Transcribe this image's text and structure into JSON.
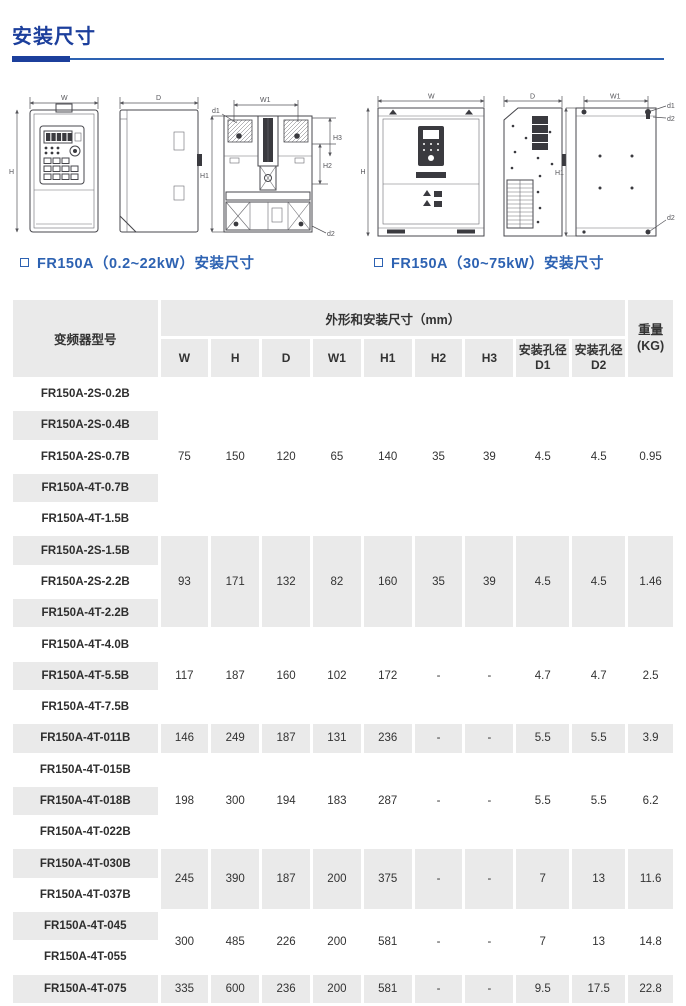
{
  "page": {
    "title": "安装尺寸"
  },
  "colors": {
    "heading_blue": "#1c3f9c",
    "caption_blue": "#2d62b2",
    "row_gray": "#eaeaea",
    "text_dark": "#333333"
  },
  "figures": {
    "small_unit": {
      "caption": "FR150A（0.2~22kW）安装尺寸",
      "labels": {
        "w": "W",
        "h": "H",
        "d": "D",
        "w1": "W1",
        "h1": "H1",
        "h2": "H2",
        "h3": "H3",
        "d1": "d1",
        "d2": "d2"
      }
    },
    "large_unit": {
      "caption": "FR150A（30~75kW）安装尺寸",
      "labels": {
        "w": "W",
        "h": "H",
        "d": "D",
        "w1": "W1",
        "h1": "H1",
        "d1": "d1",
        "d2": "d2"
      }
    }
  },
  "table": {
    "header": {
      "model": "变频器型号",
      "dims_group": "外形和安装尺寸（mm）",
      "weight_line1": "重量",
      "weight_line2": "(KG)",
      "dim_cols": [
        "W",
        "H",
        "D",
        "W1",
        "H1",
        "H2",
        "H3"
      ],
      "hole1_line1": "安装孔径",
      "hole1_line2": "D1",
      "hole2_line1": "安装孔径",
      "hole2_line2": "D2"
    },
    "groups": [
      {
        "models": [
          "FR150A-2S-0.2B",
          "FR150A-2S-0.4B",
          "FR150A-2S-0.7B",
          "FR150A-4T-0.7B",
          "FR150A-4T-1.5B"
        ],
        "values": [
          "75",
          "150",
          "120",
          "65",
          "140",
          "35",
          "39",
          "4.5",
          "4.5",
          "0.95"
        ]
      },
      {
        "models": [
          "FR150A-2S-1.5B",
          "FR150A-2S-2.2B",
          "FR150A-4T-2.2B"
        ],
        "values": [
          "93",
          "171",
          "132",
          "82",
          "160",
          "35",
          "39",
          "4.5",
          "4.5",
          "1.46"
        ]
      },
      {
        "models": [
          "FR150A-4T-4.0B",
          "FR150A-4T-5.5B",
          "FR150A-4T-7.5B"
        ],
        "values": [
          "117",
          "187",
          "160",
          "102",
          "172",
          "-",
          "-",
          "4.7",
          "4.7",
          "2.5"
        ]
      },
      {
        "models": [
          "FR150A-4T-011B"
        ],
        "values": [
          "146",
          "249",
          "187",
          "131",
          "236",
          "-",
          "-",
          "5.5",
          "5.5",
          "3.9"
        ]
      },
      {
        "models": [
          "FR150A-4T-015B",
          "FR150A-4T-018B",
          "FR150A-4T-022B"
        ],
        "values": [
          "198",
          "300",
          "194",
          "183",
          "287",
          "-",
          "-",
          "5.5",
          "5.5",
          "6.2"
        ]
      },
      {
        "models": [
          "FR150A-4T-030B",
          "FR150A-4T-037B"
        ],
        "values": [
          "245",
          "390",
          "187",
          "200",
          "375",
          "-",
          "-",
          "7",
          "13",
          "11.6"
        ]
      },
      {
        "models": [
          "FR150A-4T-045",
          "FR150A-4T-055"
        ],
        "values": [
          "300",
          "485",
          "226",
          "200",
          "581",
          "-",
          "-",
          "7",
          "13",
          "14.8"
        ]
      },
      {
        "models": [
          "FR150A-4T-075"
        ],
        "values": [
          "335",
          "600",
          "236",
          "200",
          "581",
          "-",
          "-",
          "9.5",
          "17.5",
          "22.8"
        ]
      }
    ]
  }
}
